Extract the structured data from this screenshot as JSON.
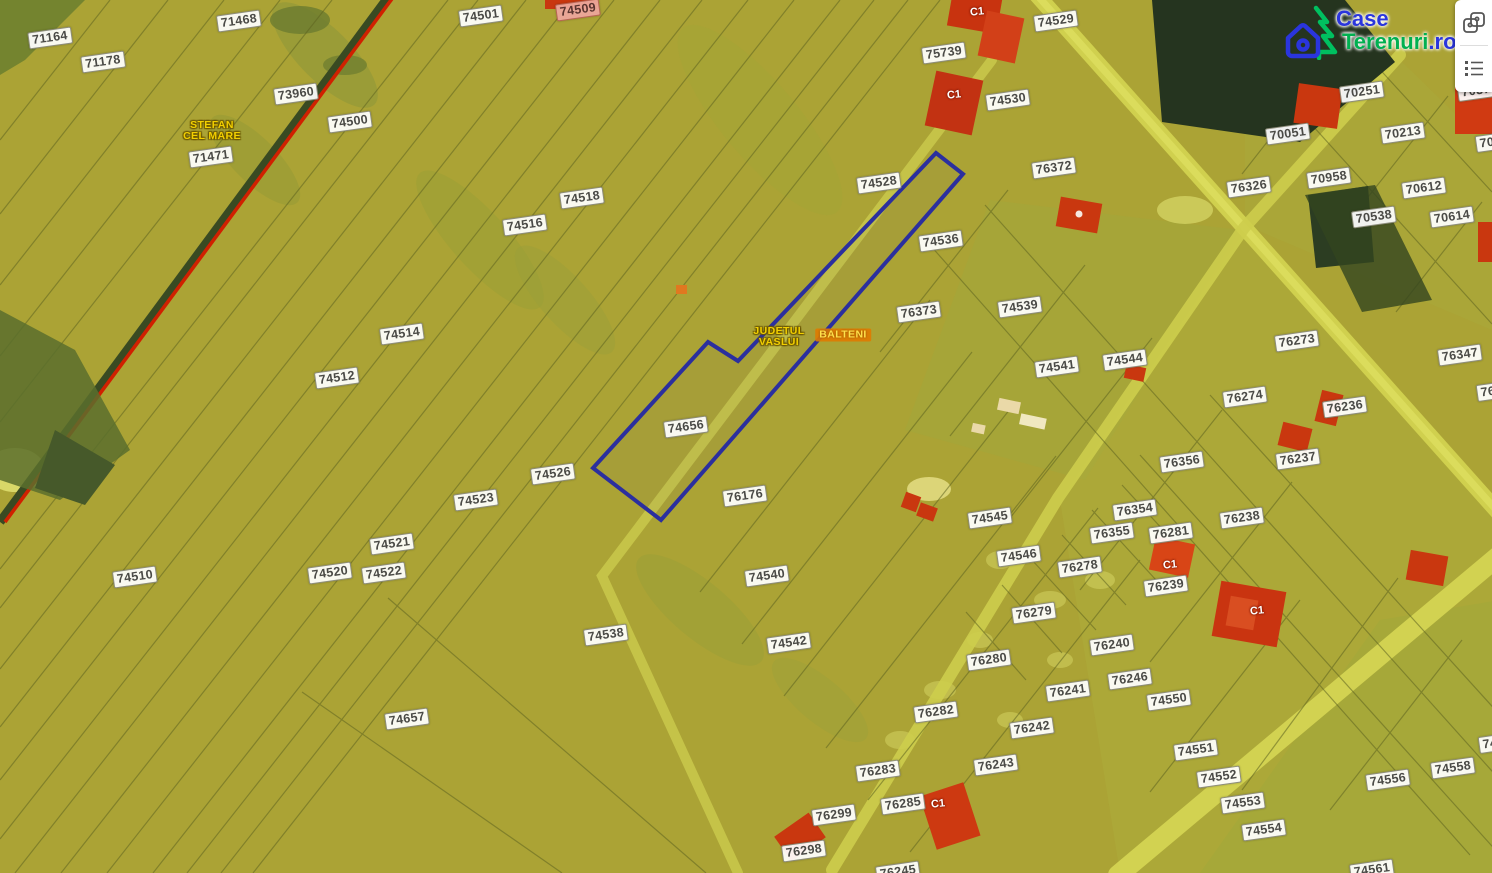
{
  "app": {
    "logo": {
      "part1": "Case",
      "part2": "Terenuri",
      "part3": ".ro",
      "blue": "#2a35dd",
      "green": "#00b050",
      "icons": [
        "pine-tree-icon",
        "house-icon"
      ]
    },
    "toolbar": {
      "buttons": [
        {
          "name": "compare-maps",
          "icon": "compare-icon"
        },
        {
          "name": "legend",
          "icon": "legend-list-icon"
        }
      ]
    }
  },
  "map": {
    "colors": {
      "field": "#aba335",
      "road": "#d0d04e",
      "forest": "#25341f",
      "building": "#c9370f",
      "railway_red": "#d02000",
      "highlight_stroke": "#2b2f9e",
      "label_bg": "#ffffff"
    },
    "highlight": {
      "points": "936,153 963,174 661,520 593,468 708,342 738,361",
      "parcel": "74656"
    },
    "region_labels": [
      {
        "lines": [
          "STEFAN",
          "CEL MARE"
        ],
        "x": 212,
        "y": 131,
        "style": "yellow"
      },
      {
        "lines": [
          "JUDETUL",
          "VASLUI"
        ],
        "x": 779,
        "y": 337,
        "style": "yellow"
      },
      {
        "lines": [
          "BALTENI"
        ],
        "x": 843,
        "y": 335,
        "style": "orange"
      }
    ],
    "building_labels": [
      {
        "text": "C1",
        "x": 977,
        "y": 12
      },
      {
        "text": "C1",
        "x": 954,
        "y": 95
      },
      {
        "text": "C1",
        "x": 1170,
        "y": 565
      },
      {
        "text": "C1",
        "x": 1257,
        "y": 611
      },
      {
        "text": "C1",
        "x": 938,
        "y": 804
      }
    ],
    "parcel_labels": [
      {
        "text": "71164",
        "x": 50,
        "y": 38
      },
      {
        "text": "71178",
        "x": 103,
        "y": 62
      },
      {
        "text": "71468",
        "x": 239,
        "y": 21
      },
      {
        "text": "73960",
        "x": 296,
        "y": 94
      },
      {
        "text": "74500",
        "x": 350,
        "y": 122
      },
      {
        "text": "71471",
        "x": 211,
        "y": 157
      },
      {
        "text": "74501",
        "x": 481,
        "y": 16
      },
      {
        "text": "74509",
        "x": 578,
        "y": 10,
        "variant": "red"
      },
      {
        "text": "74518",
        "x": 582,
        "y": 198
      },
      {
        "text": "74516",
        "x": 525,
        "y": 225
      },
      {
        "text": "74514",
        "x": 402,
        "y": 334
      },
      {
        "text": "74512",
        "x": 337,
        "y": 378
      },
      {
        "text": "74510",
        "x": 135,
        "y": 577
      },
      {
        "text": "74526",
        "x": 553,
        "y": 474
      },
      {
        "text": "74523",
        "x": 476,
        "y": 500
      },
      {
        "text": "74521",
        "x": 392,
        "y": 544
      },
      {
        "text": "74520",
        "x": 330,
        "y": 573
      },
      {
        "text": "74522",
        "x": 384,
        "y": 573
      },
      {
        "text": "74657",
        "x": 407,
        "y": 719
      },
      {
        "text": "74538",
        "x": 606,
        "y": 635
      },
      {
        "text": "74656",
        "x": 686,
        "y": 427
      },
      {
        "text": "76176",
        "x": 745,
        "y": 496
      },
      {
        "text": "74540",
        "x": 767,
        "y": 576
      },
      {
        "text": "74542",
        "x": 789,
        "y": 643
      },
      {
        "text": "74528",
        "x": 879,
        "y": 183
      },
      {
        "text": "75739",
        "x": 944,
        "y": 53
      },
      {
        "text": "74529",
        "x": 1056,
        "y": 21
      },
      {
        "text": "74530",
        "x": 1008,
        "y": 100
      },
      {
        "text": "76372",
        "x": 1054,
        "y": 168
      },
      {
        "text": "74536",
        "x": 941,
        "y": 241
      },
      {
        "text": "76373",
        "x": 919,
        "y": 312
      },
      {
        "text": "74539",
        "x": 1020,
        "y": 307
      },
      {
        "text": "74541",
        "x": 1057,
        "y": 367
      },
      {
        "text": "74544",
        "x": 1125,
        "y": 360
      },
      {
        "text": "74545",
        "x": 990,
        "y": 518
      },
      {
        "text": "74546",
        "x": 1019,
        "y": 556
      },
      {
        "text": "76278",
        "x": 1080,
        "y": 567
      },
      {
        "text": "76279",
        "x": 1034,
        "y": 613
      },
      {
        "text": "76280",
        "x": 989,
        "y": 660
      },
      {
        "text": "76282",
        "x": 936,
        "y": 712
      },
      {
        "text": "76283",
        "x": 878,
        "y": 771
      },
      {
        "text": "76285",
        "x": 903,
        "y": 804
      },
      {
        "text": "76299",
        "x": 834,
        "y": 815
      },
      {
        "text": "76298",
        "x": 804,
        "y": 851
      },
      {
        "text": "76243",
        "x": 996,
        "y": 765
      },
      {
        "text": "76242",
        "x": 1032,
        "y": 728
      },
      {
        "text": "76241",
        "x": 1068,
        "y": 691
      },
      {
        "text": "76240",
        "x": 1112,
        "y": 645
      },
      {
        "text": "76246",
        "x": 1130,
        "y": 679
      },
      {
        "text": "74550",
        "x": 1169,
        "y": 700
      },
      {
        "text": "76239",
        "x": 1166,
        "y": 586
      },
      {
        "text": "76238",
        "x": 1242,
        "y": 518
      },
      {
        "text": "76281",
        "x": 1171,
        "y": 533
      },
      {
        "text": "76355",
        "x": 1112,
        "y": 533
      },
      {
        "text": "76354",
        "x": 1135,
        "y": 510
      },
      {
        "text": "76356",
        "x": 1182,
        "y": 462
      },
      {
        "text": "76274",
        "x": 1245,
        "y": 397
      },
      {
        "text": "76236",
        "x": 1345,
        "y": 407
      },
      {
        "text": "76237",
        "x": 1298,
        "y": 459
      },
      {
        "text": "76273",
        "x": 1297,
        "y": 341
      },
      {
        "text": "76347",
        "x": 1460,
        "y": 355
      },
      {
        "text": "76326",
        "x": 1249,
        "y": 187
      },
      {
        "text": "70251",
        "x": 1362,
        "y": 92
      },
      {
        "text": "70051",
        "x": 1288,
        "y": 134
      },
      {
        "text": "70213",
        "x": 1403,
        "y": 133
      },
      {
        "text": "70958",
        "x": 1329,
        "y": 178
      },
      {
        "text": "70612",
        "x": 1424,
        "y": 188
      },
      {
        "text": "70614",
        "x": 1452,
        "y": 217
      },
      {
        "text": "70538",
        "x": 1374,
        "y": 217
      },
      {
        "text": "74551",
        "x": 1196,
        "y": 750
      },
      {
        "text": "74552",
        "x": 1219,
        "y": 777
      },
      {
        "text": "74553",
        "x": 1243,
        "y": 803
      },
      {
        "text": "74554",
        "x": 1264,
        "y": 830
      },
      {
        "text": "74556",
        "x": 1388,
        "y": 780
      },
      {
        "text": "74558",
        "x": 1453,
        "y": 768
      },
      {
        "text": "7037",
        "x": 1476,
        "y": 91
      },
      {
        "text": "70",
        "x": 1487,
        "y": 143
      },
      {
        "text": "76",
        "x": 1488,
        "y": 392
      },
      {
        "text": "74",
        "x": 1490,
        "y": 744
      },
      {
        "text": "74561",
        "x": 1372,
        "y": 870
      },
      {
        "text": "76245",
        "x": 898,
        "y": 872
      }
    ]
  }
}
